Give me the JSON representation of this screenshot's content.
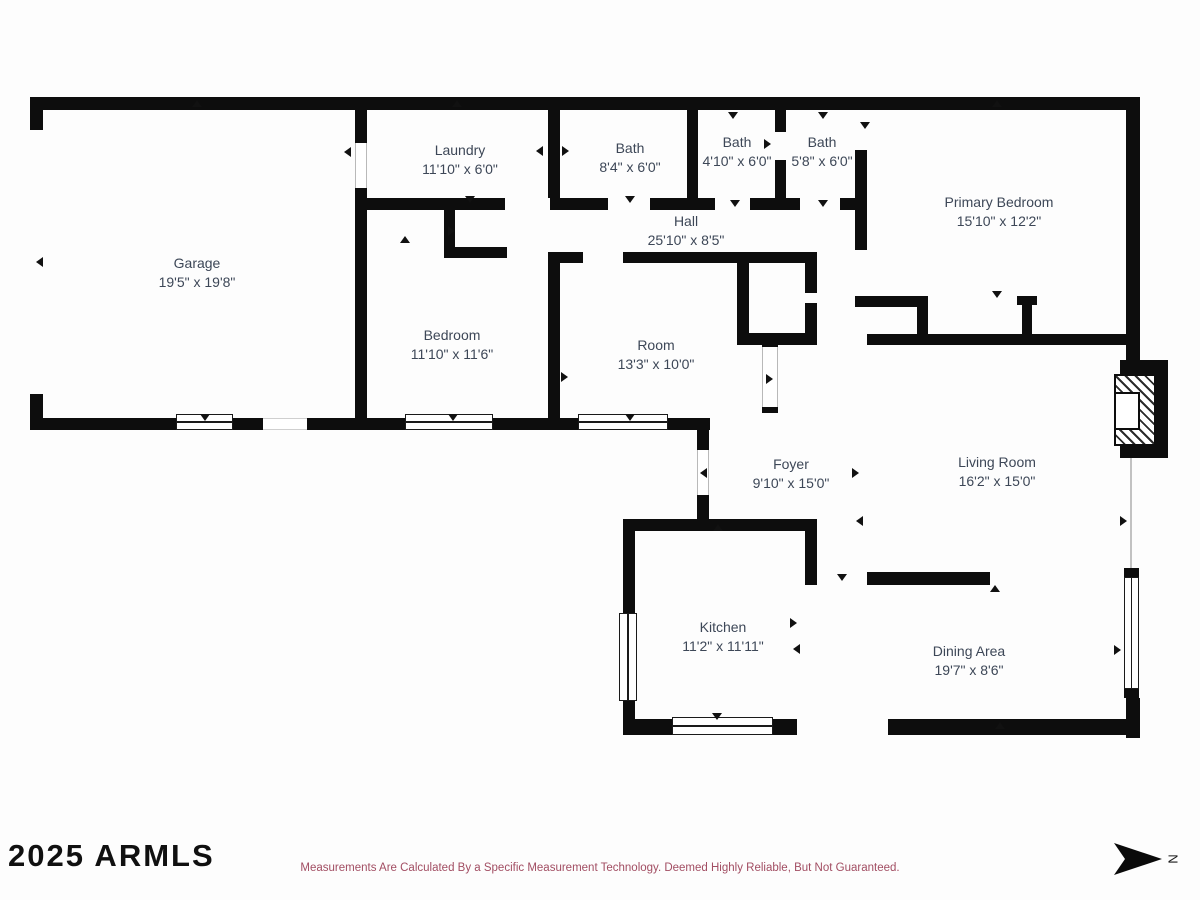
{
  "rooms": [
    {
      "id": "garage",
      "name": "Garage",
      "dims": "19'5\" x 19'8\""
    },
    {
      "id": "laundry",
      "name": "Laundry",
      "dims": "11'10\" x 6'0\""
    },
    {
      "id": "bath-1",
      "name": "Bath",
      "dims": "8'4\" x 6'0\""
    },
    {
      "id": "bath-2",
      "name": "Bath",
      "dims": "4'10\" x 6'0\""
    },
    {
      "id": "bath-3",
      "name": "Bath",
      "dims": "5'8\" x 6'0\""
    },
    {
      "id": "hall",
      "name": "Hall",
      "dims": "25'10\" x 8'5\""
    },
    {
      "id": "primary-bedroom",
      "name": "Primary Bedroom",
      "dims": "15'10\" x 12'2\""
    },
    {
      "id": "bedroom",
      "name": "Bedroom",
      "dims": "11'10\" x 11'6\""
    },
    {
      "id": "room",
      "name": "Room",
      "dims": "13'3\" x 10'0\""
    },
    {
      "id": "foyer",
      "name": "Foyer",
      "dims": "9'10\" x 15'0\""
    },
    {
      "id": "living-room",
      "name": "Living Room",
      "dims": "16'2\" x 15'0\""
    },
    {
      "id": "kitchen",
      "name": "Kitchen",
      "dims": "11'2\" x 11'11\""
    },
    {
      "id": "dining-area",
      "name": "Dining Area",
      "dims": "19'7\" x 8'6\""
    }
  ],
  "footer": {
    "watermark": "2025 ARMLS",
    "disclaimer": "Measurements Are Calculated By a Specific Measurement Technology. Deemed Highly Reliable, But Not Guaranteed.",
    "compass_label": "N"
  },
  "colors": {
    "wall": "#0d0d0d",
    "label_text": "#3d4757",
    "disclaimer_text": "#a24e63",
    "watermark_text": "#101010",
    "background": "#fdfdfd"
  }
}
